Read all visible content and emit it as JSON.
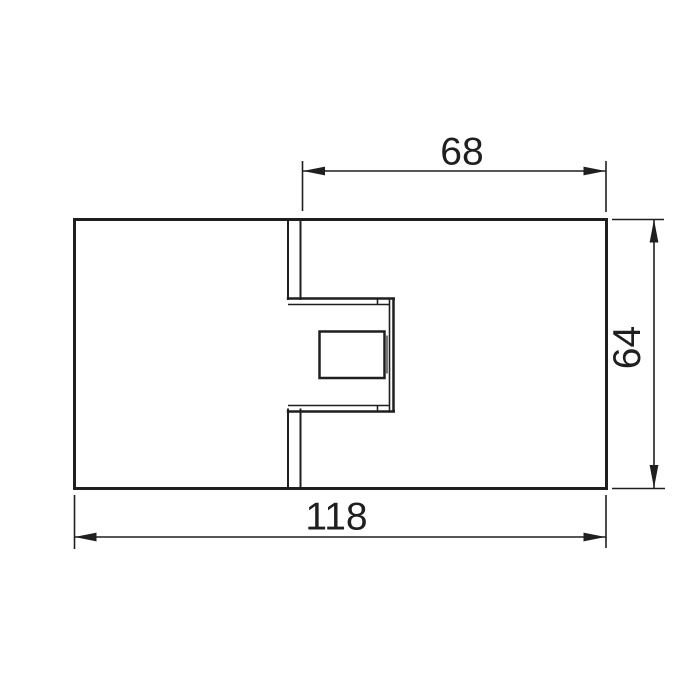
{
  "drawing": {
    "kind": "technical-dimension-drawing",
    "line_color": "#1f1f1f",
    "background_color": "#ffffff",
    "dimensions": {
      "inset_width": "68",
      "overall_height": "64",
      "overall_width": "118"
    }
  }
}
